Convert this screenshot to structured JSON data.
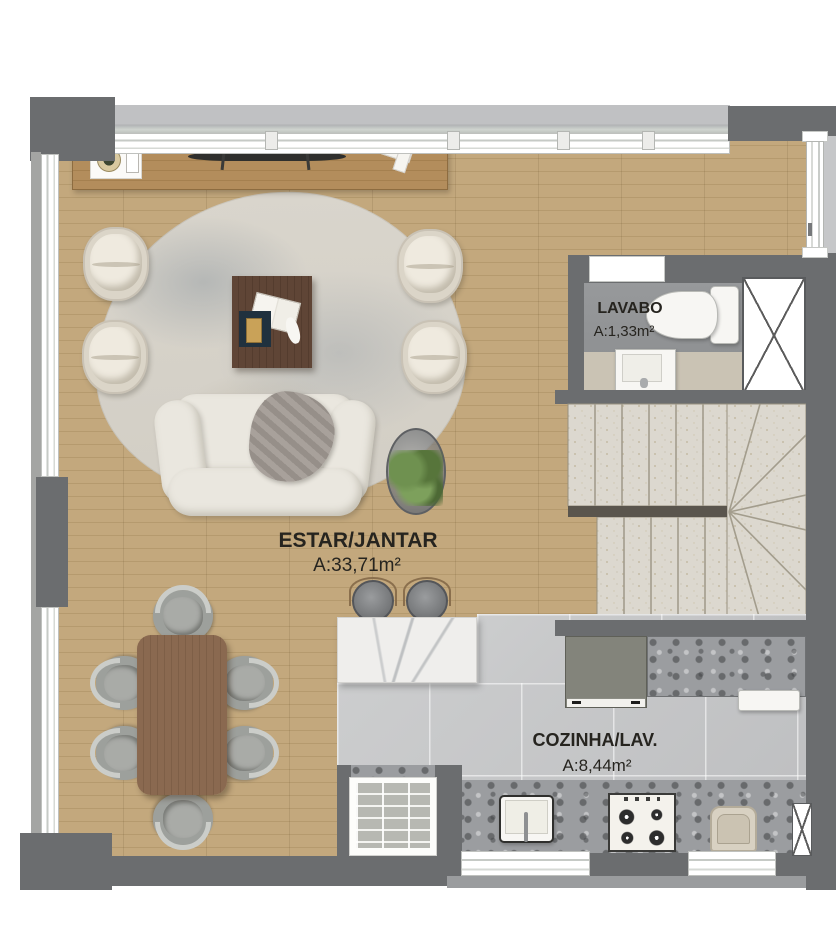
{
  "plan_title": "residential-unit-floor-plan",
  "rooms": {
    "estar": {
      "label": "ESTAR/JANTAR",
      "area": "A:33,71m²"
    },
    "lavabo": {
      "label": "LAVABO",
      "area": "A:1,33m²"
    },
    "cozinha": {
      "label": "COZINHA/LAV.",
      "area": "A:8,44m²"
    }
  },
  "elements": [
    "sofa",
    "armchairs",
    "coffee-table",
    "area-rug",
    "side-table-with-plant",
    "sideboard",
    "dining-table-with-6-chairs",
    "kitchen-island-with-2-stools",
    "refrigerator",
    "kitchen-counter",
    "kitchen-sink",
    "gas-cooktop",
    "laundry-tank",
    "toilet",
    "washbasin",
    "u-shaped-stairs",
    "ventilation-shafts",
    "entry-door",
    "windows",
    "brick-shaft"
  ],
  "colors": {
    "wall": "#6b6d6f",
    "ledge": "#b9babc",
    "wood_floor": "#bda274",
    "kitchen_tile": "#c6c7c9",
    "travertine_stairs": "#dcd8cf",
    "granite_counter": "#9b9da0",
    "marble_island": "#efeeec",
    "sofa_cream": "#eae7df",
    "dining_wood": "#876750",
    "label_text": "#26241f"
  }
}
